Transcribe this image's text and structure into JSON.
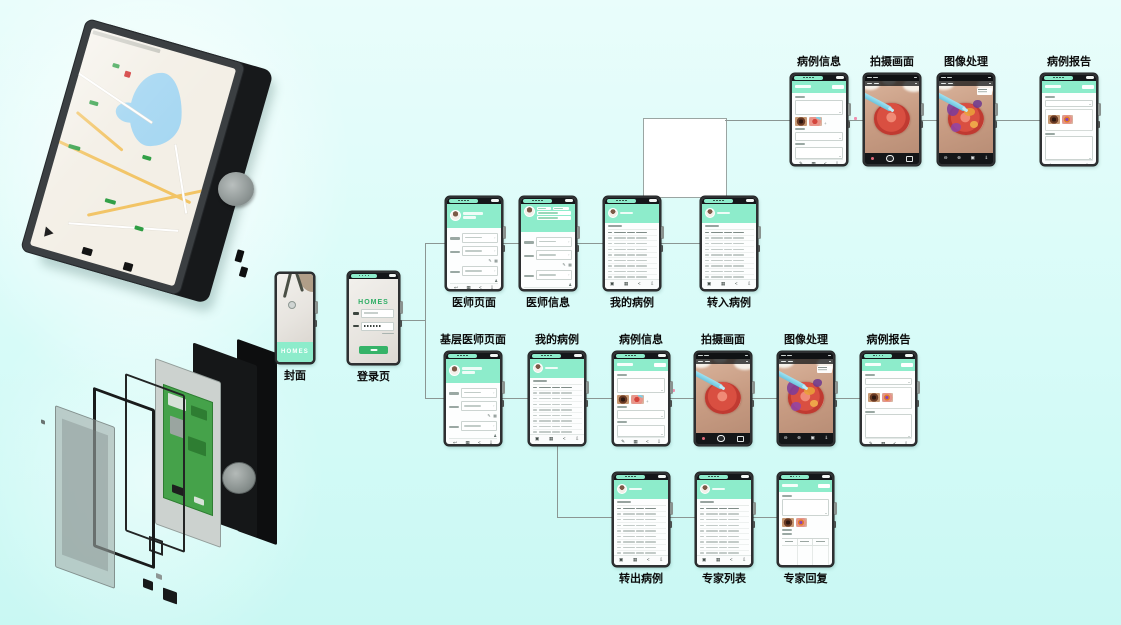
{
  "figure": {
    "colors": {
      "background_top": "#e9fdfb",
      "background_bottom": "#c9f8f3",
      "mint": "#8deccb",
      "brand_green": "#35b368",
      "phone_frame": "#2e3032",
      "connector_line": "#8b9693",
      "pcb_green": "#45a24a"
    }
  },
  "brand": {
    "name": "HOMES"
  },
  "icons": {
    "back": "↩",
    "grid": "▦",
    "left": "<",
    "download": "⇩",
    "minus": "⊖",
    "plus": "⊕",
    "box": "▣",
    "down": "⇓",
    "edit": "✎",
    "key": "♟",
    "add": "+",
    "chevron": "›"
  },
  "hardware": {
    "map_device": "handheld device rendering with on-screen map",
    "exploded_view": "exploded rendering of device layers with PCB and knob"
  },
  "flow": {
    "nodes": [
      {
        "id": "cover",
        "label": "封面",
        "type": "splash",
        "x": 275,
        "y": 272,
        "w": 40,
        "h": 92,
        "lp": "below"
      },
      {
        "id": "login",
        "label": "登录页",
        "type": "login",
        "x": 347,
        "y": 271,
        "w": 53,
        "h": 94,
        "lp": "below"
      },
      {
        "id": "doctor-page",
        "label": "医师页面",
        "type": "profile",
        "x": 445,
        "y": 196,
        "w": 58,
        "h": 95,
        "lp": "below"
      },
      {
        "id": "doctor-info",
        "label": "医师信息",
        "type": "profile2",
        "x": 519,
        "y": 196,
        "w": 58,
        "h": 95,
        "lp": "below"
      },
      {
        "id": "my-cases",
        "label": "我的病例",
        "type": "table",
        "x": 603,
        "y": 196,
        "w": 58,
        "h": 95,
        "lp": "below"
      },
      {
        "id": "transfer-in",
        "label": "转入病例",
        "type": "table",
        "x": 700,
        "y": 196,
        "w": 58,
        "h": 95,
        "lp": "below"
      },
      {
        "id": "case-info",
        "label": "病例信息",
        "type": "caseinfo",
        "x": 790,
        "y": 73,
        "w": 58,
        "h": 93,
        "lp": "above"
      },
      {
        "id": "capture",
        "label": "拍摄画面",
        "type": "camera",
        "x": 863,
        "y": 73,
        "w": 58,
        "h": 93,
        "lp": "above"
      },
      {
        "id": "processing",
        "label": "图像处理",
        "type": "processed",
        "x": 937,
        "y": 73,
        "w": 58,
        "h": 93,
        "lp": "above"
      },
      {
        "id": "report",
        "label": "病例报告",
        "type": "report",
        "x": 1040,
        "y": 73,
        "w": 58,
        "h": 93,
        "lp": "above"
      },
      {
        "id": "primary-doctor",
        "label": "基层医师页面",
        "type": "profile",
        "x": 444,
        "y": 351,
        "w": 58,
        "h": 95,
        "lp": "above"
      },
      {
        "id": "my-cases-2",
        "label": "我的病例",
        "type": "table",
        "x": 528,
        "y": 351,
        "w": 58,
        "h": 95,
        "lp": "above"
      },
      {
        "id": "case-info-2",
        "label": "病例信息",
        "type": "caseinfo",
        "x": 612,
        "y": 351,
        "w": 58,
        "h": 95,
        "lp": "above"
      },
      {
        "id": "capture-2",
        "label": "拍摄画面",
        "type": "camera",
        "x": 694,
        "y": 351,
        "w": 58,
        "h": 95,
        "lp": "above"
      },
      {
        "id": "processing-2",
        "label": "图像处理",
        "type": "processed",
        "x": 777,
        "y": 351,
        "w": 58,
        "h": 95,
        "lp": "above"
      },
      {
        "id": "report-2",
        "label": "病例报告",
        "type": "report",
        "x": 860,
        "y": 351,
        "w": 57,
        "h": 95,
        "lp": "above"
      },
      {
        "id": "transfer-out",
        "label": "转出病例",
        "type": "table",
        "x": 612,
        "y": 472,
        "w": 58,
        "h": 95,
        "lp": "below"
      },
      {
        "id": "expert-list",
        "label": "专家列表",
        "type": "table",
        "x": 695,
        "y": 472,
        "w": 58,
        "h": 95,
        "lp": "below"
      },
      {
        "id": "expert-reply",
        "label": "专家回复",
        "type": "reply",
        "x": 777,
        "y": 472,
        "w": 57,
        "h": 95,
        "lp": "below"
      }
    ],
    "edges": [
      [
        400,
        320,
        425,
        320
      ],
      [
        425,
        243,
        425,
        398
      ],
      [
        425,
        243,
        445,
        243
      ],
      [
        425,
        398,
        444,
        398
      ],
      [
        503,
        243,
        519,
        243
      ],
      [
        577,
        243,
        603,
        243
      ],
      [
        661,
        243,
        700,
        243
      ],
      [
        725,
        120,
        790,
        120
      ],
      [
        848,
        120,
        863,
        120
      ],
      [
        921,
        120,
        937,
        120
      ],
      [
        995,
        120,
        1040,
        120
      ],
      [
        502,
        398,
        528,
        398
      ],
      [
        586,
        398,
        612,
        398
      ],
      [
        670,
        398,
        694,
        398
      ],
      [
        752,
        398,
        777,
        398
      ],
      [
        835,
        398,
        860,
        398
      ],
      [
        557,
        446,
        557,
        517
      ],
      [
        557,
        517,
        612,
        517
      ],
      [
        670,
        517,
        695,
        517
      ],
      [
        753,
        517,
        777,
        517
      ]
    ],
    "junction_box": {
      "x": 643,
      "y": 118,
      "w": 82,
      "h": 78
    },
    "marks": [
      {
        "x": 854,
        "y": 117
      },
      {
        "x": 672,
        "y": 389
      }
    ]
  }
}
